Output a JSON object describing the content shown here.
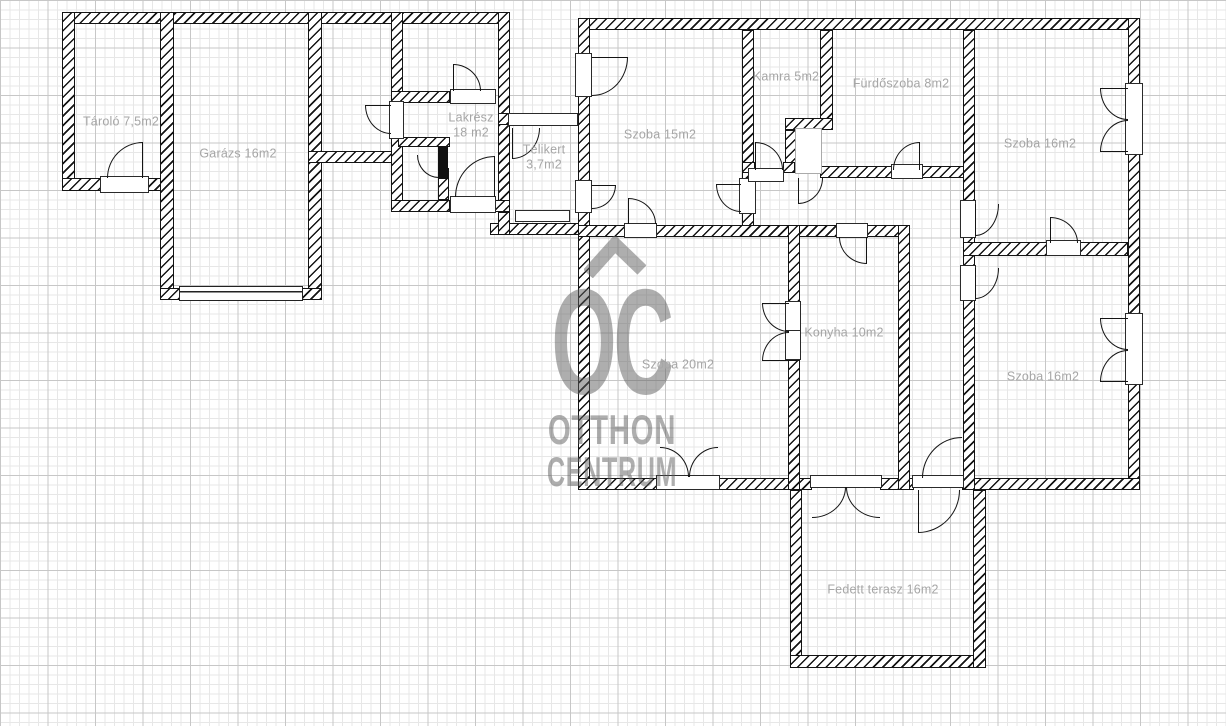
{
  "watermark": {
    "logo_text": "OC",
    "line1": "OTTHON",
    "line2": "CENTRUM"
  },
  "rooms": {
    "tarolo": {
      "label": "Tároló 7,5m2"
    },
    "garazs": {
      "label": "Garázs 16m2"
    },
    "lakresz": {
      "label": "Lakrész\n18 m2"
    },
    "telikert": {
      "label": "Télikert\n3,7m2"
    },
    "szoba15": {
      "label": "Szoba 15m2"
    },
    "kamra": {
      "label": "Kamra 5m2"
    },
    "furdoszoba": {
      "label": "Fürdőszoba 8m2"
    },
    "szoba16_felso": {
      "label": "Szoba 16m2"
    },
    "szoba20": {
      "label": "Szoba 20m2"
    },
    "konyha": {
      "label": "Konyha 10m2"
    },
    "szoba16_also": {
      "label": "Szoba 16m2"
    },
    "fedett_terasz": {
      "label": "Fedett terasz 16m2"
    }
  },
  "colors": {
    "wall_line": "#141414",
    "label_text": "#a6a6a6",
    "watermark_gray": "#5f5f5f",
    "grid_minor": "#e7e7e7",
    "grid_major": "#c7c7c7"
  }
}
